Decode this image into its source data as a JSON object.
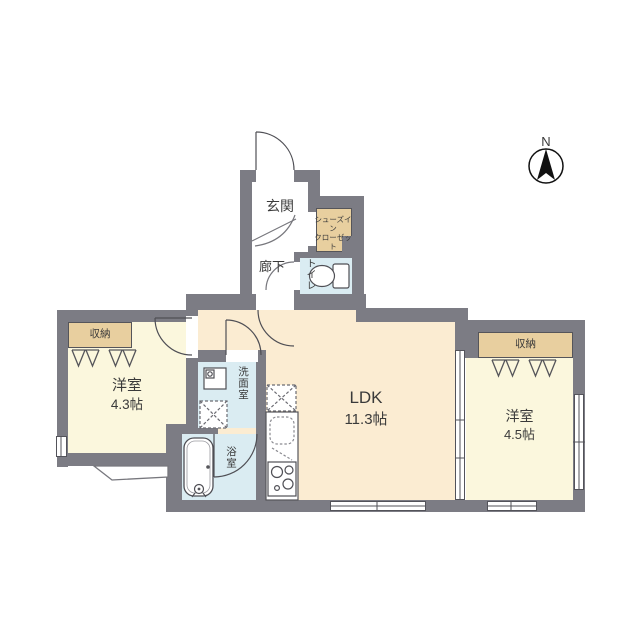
{
  "plan_type": "apartment-floor-plan",
  "compass": {
    "north_label": "N"
  },
  "rooms": {
    "genkan": {
      "label": "玄関"
    },
    "hallway": {
      "label": "廊下"
    },
    "toilet": {
      "label": "トイレ"
    },
    "shoe_closet": {
      "label_line1": "シューズイン",
      "label_line2": "クローゼット"
    },
    "storage_left": {
      "label": "収納"
    },
    "storage_right": {
      "label": "収納"
    },
    "western_room_left": {
      "label": "洋室",
      "size": "4.3帖"
    },
    "ldk": {
      "label": "LDK",
      "size": "11.3帖"
    },
    "western_room_right": {
      "label": "洋室",
      "size": "4.5帖"
    },
    "washroom": {
      "label": "洗面室"
    },
    "bathroom": {
      "label": "浴室"
    }
  },
  "colors": {
    "wall": "#7c7c84",
    "ldk_floor": "#fbecd2",
    "bedroom_floor": "#fbf7dd",
    "wet_area_floor": "#daecf2",
    "storage_fill": "#e8cf9f",
    "line": "#4f4f55",
    "text": "#3a3a3a"
  }
}
